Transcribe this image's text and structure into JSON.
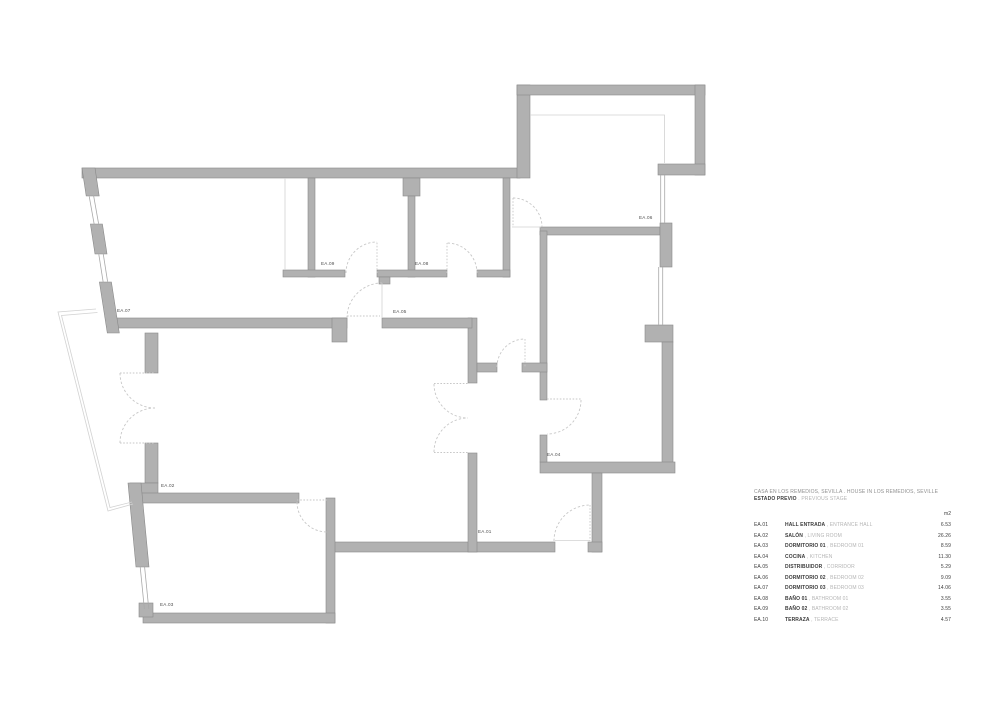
{
  "colors": {
    "wall": "#b1b1b1",
    "wall-edge": "#898989",
    "door": "#c7c7c7",
    "thin": "#d2d2d2",
    "win": "#a9a9a9",
    "label": "#4d4d4d",
    "dark": "#3c3c3c",
    "mid": "#8f8f8f",
    "light": "#b5b5b5"
  },
  "plan": {
    "labels": [
      {
        "id": "ea07",
        "text": "EA.07"
      },
      {
        "id": "ea09",
        "text": "EA.09"
      },
      {
        "id": "ea08",
        "text": "EA.08"
      },
      {
        "id": "ea05",
        "text": "EA.05"
      },
      {
        "id": "ea06",
        "text": "EA.06"
      },
      {
        "id": "ea04",
        "text": "EA.04"
      },
      {
        "id": "ea02",
        "text": "EA.02"
      },
      {
        "id": "ea01",
        "text": "EA.01"
      },
      {
        "id": "ea03",
        "text": "EA.03"
      }
    ]
  },
  "legend": {
    "title": "CASA EN LOS REMEDIOS, SEVILLA . HOUSE IN LOS REMEDIOS, SEVILLE",
    "subtitle_bold": "ESTADO PREVIO",
    "subtitle_light": " . PREVIOUS STAGE",
    "unit_header": "m2",
    "sep": " , ",
    "rows": [
      {
        "code": "EA.01",
        "name_es": "HALL ENTRADA",
        "name_en": "ENTRANCE HALL",
        "area": "6.53"
      },
      {
        "code": "EA.02",
        "name_es": "SALÓN",
        "name_en": "LIVING ROOM",
        "area": "26.26"
      },
      {
        "code": "EA.03",
        "name_es": "DORMITORIO 01",
        "name_en": "BEDROOM 01",
        "area": "8.59"
      },
      {
        "code": "EA.04",
        "name_es": "COCINA",
        "name_en": "KITCHEN",
        "area": "11.30"
      },
      {
        "code": "EA.05",
        "name_es": "DISTRIBUIDOR",
        "name_en": "CORRIDOR",
        "area": "5.29"
      },
      {
        "code": "EA.06",
        "name_es": "DORMITORIO 02",
        "name_en": "BEDROOM 02",
        "area": "9.09"
      },
      {
        "code": "EA.07",
        "name_es": "DORMITORIO 03",
        "name_en": "BEDROOM 03",
        "area": "14.06"
      },
      {
        "code": "EA.08",
        "name_es": "BAÑO 01",
        "name_en": "BATHROOM 01",
        "area": "3.55"
      },
      {
        "code": "EA.09",
        "name_es": "BAÑO 02",
        "name_en": "BATHROOM 02",
        "area": "3.55"
      },
      {
        "code": "EA.10",
        "name_es": "TERRAZA",
        "name_en": "TERRACE",
        "area": "4.57"
      }
    ]
  }
}
